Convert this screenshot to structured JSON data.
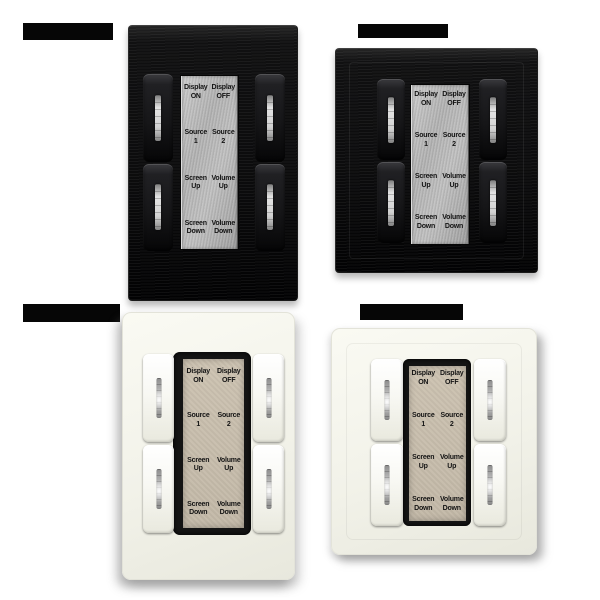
{
  "keypad_labels": {
    "rows": [
      [
        "Display\nON",
        "Display\nOFF"
      ],
      [
        "Source\n1",
        "Source\n2"
      ],
      [
        "Screen\nUp",
        "Volume\nUp"
      ],
      [
        "Screen\nDown",
        "Volume\nDown"
      ]
    ]
  },
  "panels": [
    {
      "name": "black-us-portrait-keypad",
      "finish_color": "#0b0b0c",
      "plate_color": "#b3b3b3",
      "button_count": 4
    },
    {
      "name": "black-eu-square-keypad",
      "finish_color": "#0b0b0c",
      "plate_color": "#b3b3b3",
      "button_count": 4
    },
    {
      "name": "white-us-portrait-keypad",
      "finish_color": "#f2f2e9",
      "plate_color": "#c7bdac",
      "button_count": 4
    },
    {
      "name": "white-eu-square-keypad",
      "finish_color": "#f2f2ea",
      "plate_color": "#c7bdac",
      "button_count": 4
    }
  ],
  "redacted_bars": [
    {
      "position": "top-left"
    },
    {
      "position": "top-right"
    },
    {
      "position": "bottom-left"
    },
    {
      "position": "bottom-right"
    }
  ],
  "colors": {
    "background": "#ffffff",
    "black_panel": "#0b0b0c",
    "silver_plate": "#b3b3b3",
    "white_panel": "#f2f2ea",
    "tan_plate": "#c7bdac",
    "label_text": "#141414",
    "led_indicator": "#c8c8c8"
  }
}
